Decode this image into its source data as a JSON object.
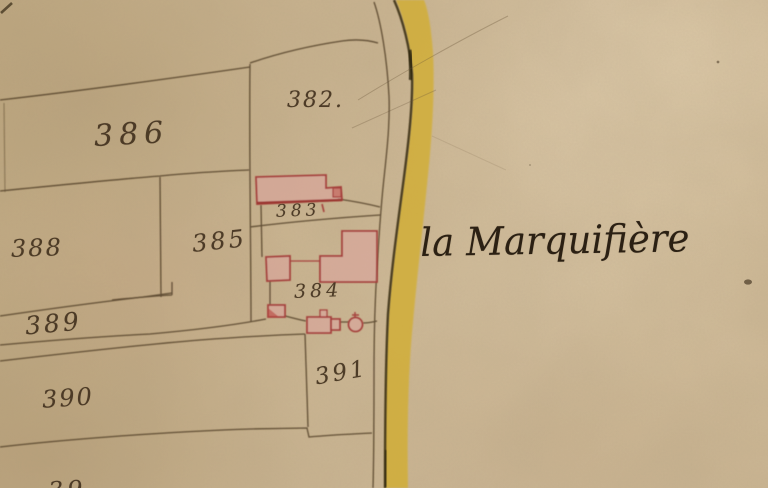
{
  "map": {
    "type": "historical-cadastral-map",
    "place_name": "la Marquifière",
    "parcel_labels": [
      {
        "id": "382",
        "label": "382."
      },
      {
        "id": "383",
        "label": "383"
      },
      {
        "id": "384",
        "label": "384"
      },
      {
        "id": "385",
        "label": "385"
      },
      {
        "id": "386",
        "label": "386"
      },
      {
        "id": "388",
        "label": "388"
      },
      {
        "id": "389",
        "label": "389"
      },
      {
        "id": "390",
        "label": "390"
      },
      {
        "id": "391",
        "label": "391"
      }
    ],
    "bottom_edge_partial_label": "39",
    "colors": {
      "paper": "#c9b28e",
      "road_yellow": "#d2ae30",
      "road_edge_ink": "#3e3116",
      "boundary_ink": "#54422a",
      "building_fill": "#dfa39e",
      "building_outline": "#a6423c",
      "label_ink": "#43321f",
      "placename_ink": "#2b2013"
    }
  }
}
